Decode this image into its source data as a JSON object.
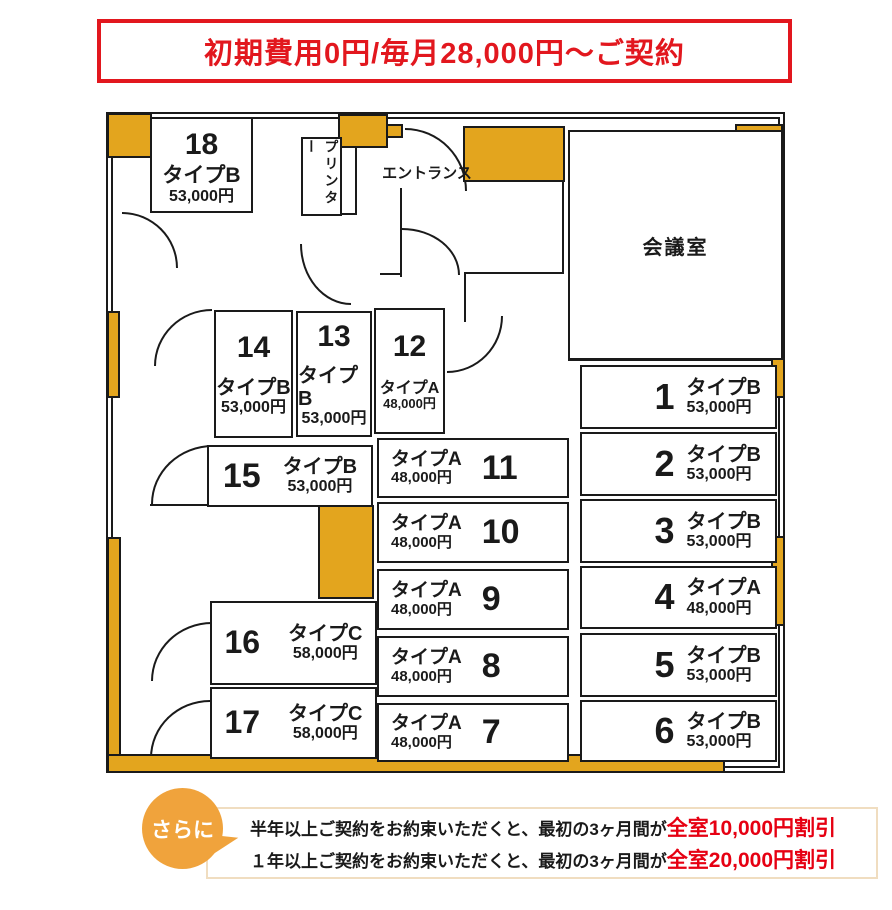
{
  "banner": {
    "text": "初期費用0円/毎月28,000円〜ご契約"
  },
  "floorplan": {
    "meeting_room_label": "会議室",
    "entrance_label": "エントランス",
    "printer_label": "プリンター",
    "rooms": [
      {
        "number": "1",
        "type": "タイプB",
        "price": "53,000円"
      },
      {
        "number": "2",
        "type": "タイプB",
        "price": "53,000円"
      },
      {
        "number": "3",
        "type": "タイプB",
        "price": "53,000円"
      },
      {
        "number": "4",
        "type": "タイプA",
        "price": "48,000円"
      },
      {
        "number": "5",
        "type": "タイプB",
        "price": "53,000円"
      },
      {
        "number": "6",
        "type": "タイプB",
        "price": "53,000円"
      },
      {
        "number": "7",
        "type": "タイプA",
        "price": "48,000円"
      },
      {
        "number": "8",
        "type": "タイプA",
        "price": "48,000円"
      },
      {
        "number": "9",
        "type": "タイプA",
        "price": "48,000円"
      },
      {
        "number": "10",
        "type": "タイプA",
        "price": "48,000円"
      },
      {
        "number": "11",
        "type": "タイプA",
        "price": "48,000円"
      },
      {
        "number": "12",
        "type": "タイプA",
        "price": "48,000円"
      },
      {
        "number": "13",
        "type": "タイプB",
        "price": "53,000円"
      },
      {
        "number": "14",
        "type": "タイプB",
        "price": "53,000円"
      },
      {
        "number": "15",
        "type": "タイプB",
        "price": "53,000円"
      },
      {
        "number": "16",
        "type": "タイプC",
        "price": "58,000円"
      },
      {
        "number": "17",
        "type": "タイプC",
        "price": "58,000円"
      },
      {
        "number": "18",
        "type": "タイプB",
        "price": "53,000円"
      }
    ]
  },
  "promo": {
    "badge": "さらに",
    "lines": [
      {
        "prefix": "半年以上ご契約をお約束いただくと、最初の3ヶ月間が",
        "highlight": "全室10,000円割引"
      },
      {
        "prefix": "１年以上ご契約をお約束いただくと、最初の3ヶ月間が",
        "highlight": "全室20,000円割引"
      }
    ]
  },
  "colors": {
    "accent_yellow": "#e3a51e",
    "bubble_orange": "#f0a33c",
    "banner_red": "#e2171e",
    "highlight_red": "#e60012"
  }
}
